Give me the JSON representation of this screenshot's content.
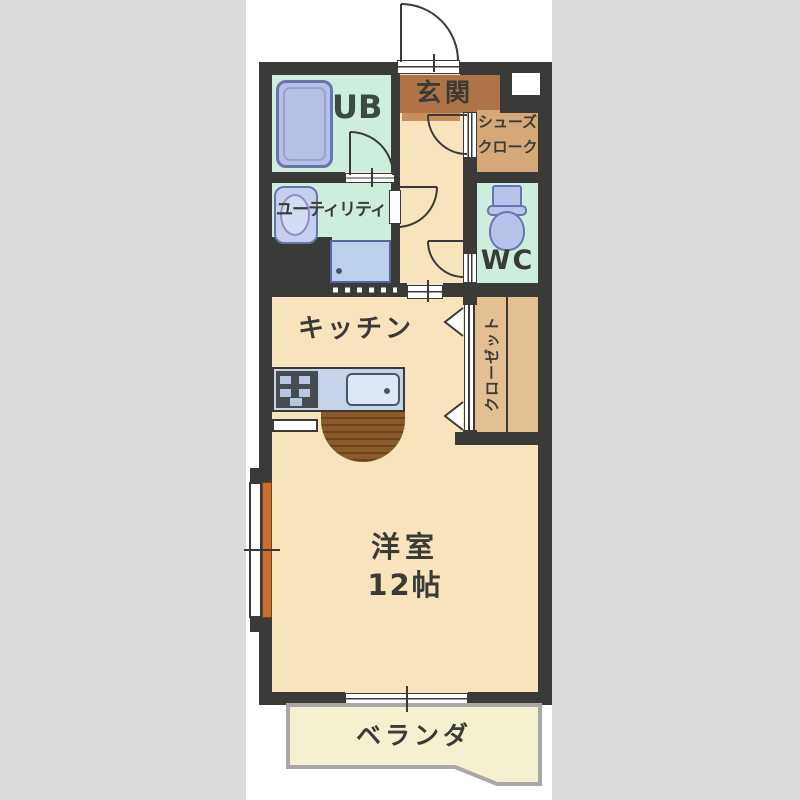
{
  "title": "1R apartment floor plan",
  "labels": {
    "genkan": "玄関",
    "shoes_cloak_line1": "シューズ",
    "shoes_cloak_line2": "クローク",
    "unit_bath": "UB",
    "utility": "ユーティリティ",
    "wc": "WC",
    "kitchen": "キッチン",
    "closet": "クローゼット",
    "main_room_name": "洋室",
    "main_room_size": "12帖",
    "veranda": "ベランダ"
  },
  "colors": {
    "background_gray": "#dcdcdc",
    "paper_white": "#ffffff",
    "wall_dark": "#3a3a38",
    "floor_cream": "#f8e4bc",
    "wet_room_green": "#cdeedd",
    "genkan_brown": "#ae7347",
    "genkan_step": "#c98f58",
    "shoes_cloak_tan": "#d5a977",
    "closet_tan": "#e2c091",
    "veranda_yellow": "#f5f0cf",
    "fixture_blue": "#b6c0e8",
    "counter_blue": "#c5d4e8",
    "counter_brown": "#8a5a28",
    "window_orange": "#c86f35",
    "text_dark": "#3b3b36"
  }
}
